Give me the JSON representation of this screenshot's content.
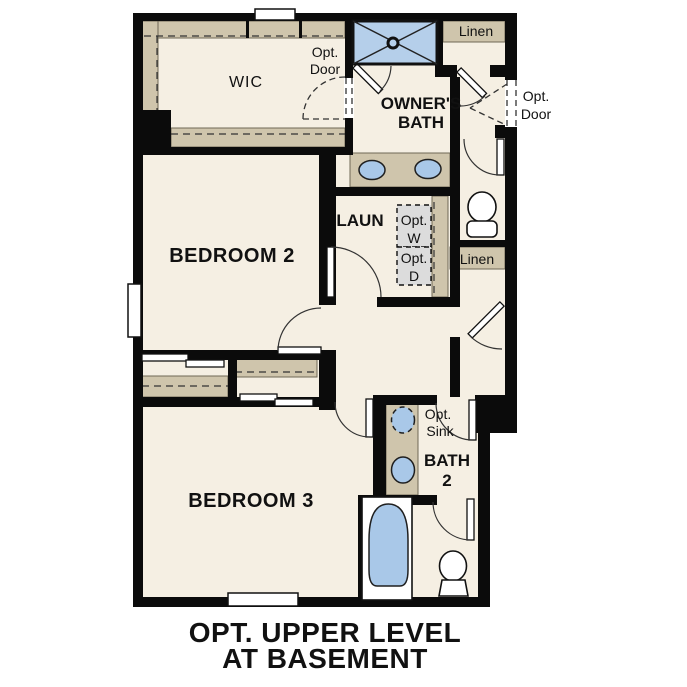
{
  "caption": {
    "line1": "OPT. UPPER LEVEL",
    "line2": "AT BASEMENT"
  },
  "rooms": {
    "wic": "WIC",
    "owners_bath": [
      "OWNER'S",
      "BATH"
    ],
    "laundry": "LAUN",
    "bedroom2": "BEDROOM 2",
    "bedroom3": "BEDROOM 3",
    "bath2": [
      "BATH",
      "2"
    ]
  },
  "closets": {
    "linen_top": "Linen",
    "linen_mid": "Linen"
  },
  "labels": {
    "opt_door_wic": [
      "Opt.",
      "Door"
    ],
    "opt_door_hall": [
      "Opt.",
      "Door"
    ],
    "opt_washer": [
      "Opt.",
      "W"
    ],
    "opt_dryer": [
      "Opt.",
      "D"
    ],
    "opt_sink": [
      "Opt.",
      "Sink"
    ]
  },
  "colors": {
    "floor": "#f5efe3",
    "wall": "#0b0b0b",
    "cabinet": "#cfc5ac",
    "fixture": "#a9c8e8",
    "shower": "#b5cfea",
    "optbox": "#dcdcdc",
    "text": "#111111"
  }
}
